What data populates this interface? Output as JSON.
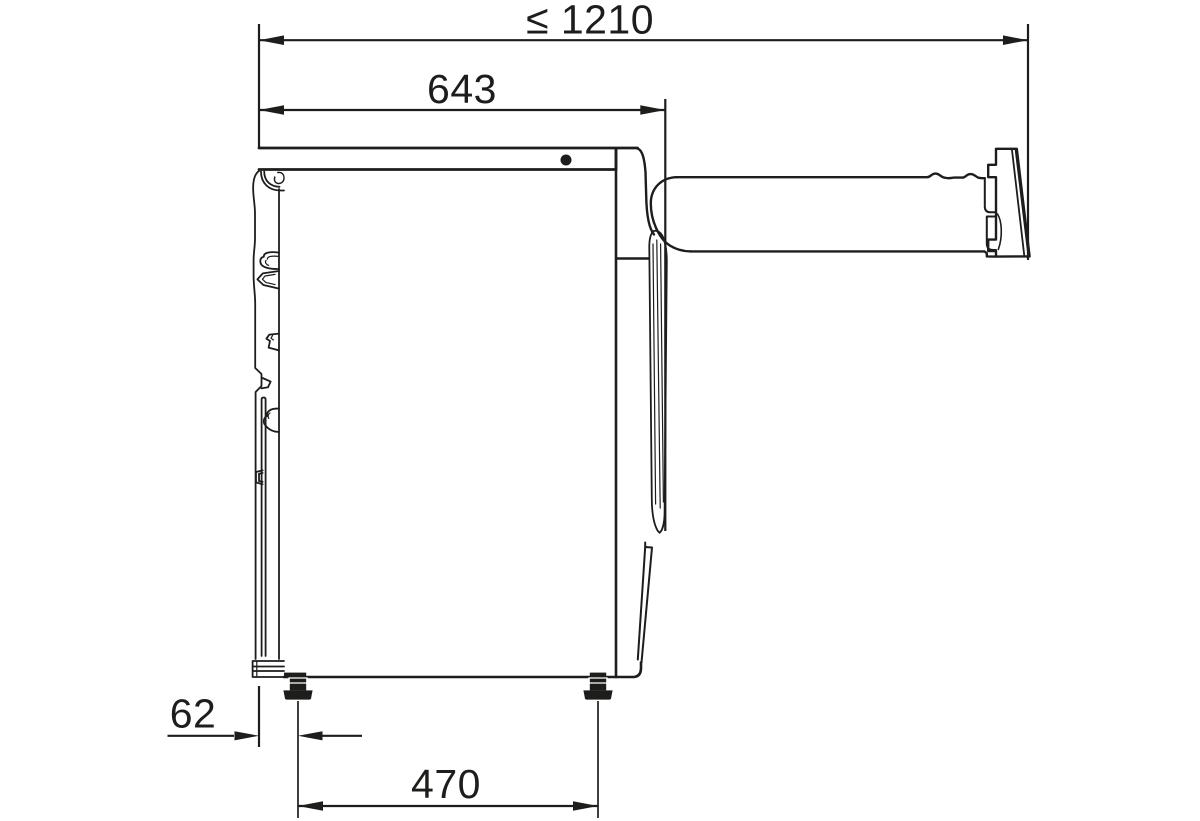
{
  "diagram": {
    "background_color": "#ffffff",
    "line_color": "#1d1d1b",
    "labels": {
      "total_depth_door_open": "≤ 1210",
      "machine_depth": "643",
      "rear_foot_to_back": "62",
      "foot_distance": "470"
    }
  }
}
